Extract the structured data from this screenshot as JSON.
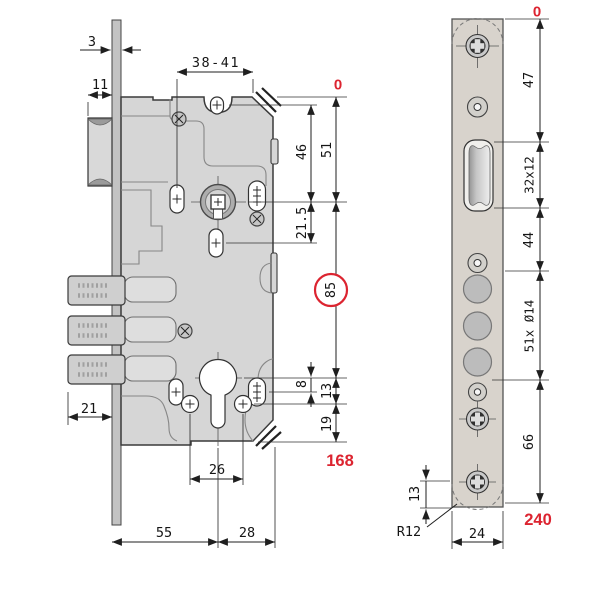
{
  "title": "Mortise lock dimensional drawing",
  "colors": {
    "red": "#dc2430",
    "line": "#1f1f1f",
    "body_fill": "#d6d6d6",
    "plate_fill": "#d8d3cc"
  },
  "body_view": {
    "plate_thickness": "3",
    "latch_protrusion": "11",
    "handle_to_edge_range": "38-41",
    "datum": "0",
    "top_to_follower_a": "46",
    "top_to_follower_b": "51",
    "follower_to_hole": "21.5",
    "follower_to_cylinder": "85",
    "cylinder_to_fix_hole": "8",
    "cylinder_to_screws": "13",
    "screws_to_bottom": "19",
    "total_height": "168",
    "bolt_throw": "21",
    "screw_spacing": "26",
    "backset": "55",
    "rear_depth": "28"
  },
  "plate_view": {
    "datum": "0",
    "top_to_latch": "47",
    "latch_cutout": "32x12",
    "latch_to_bolts": "44",
    "bolt_holes": "51x Ø14",
    "bolts_to_bottom_screw": "66",
    "bottom_screw_offset": "13",
    "total_height": "240",
    "corner_radius": "R12",
    "plate_width": "24"
  }
}
